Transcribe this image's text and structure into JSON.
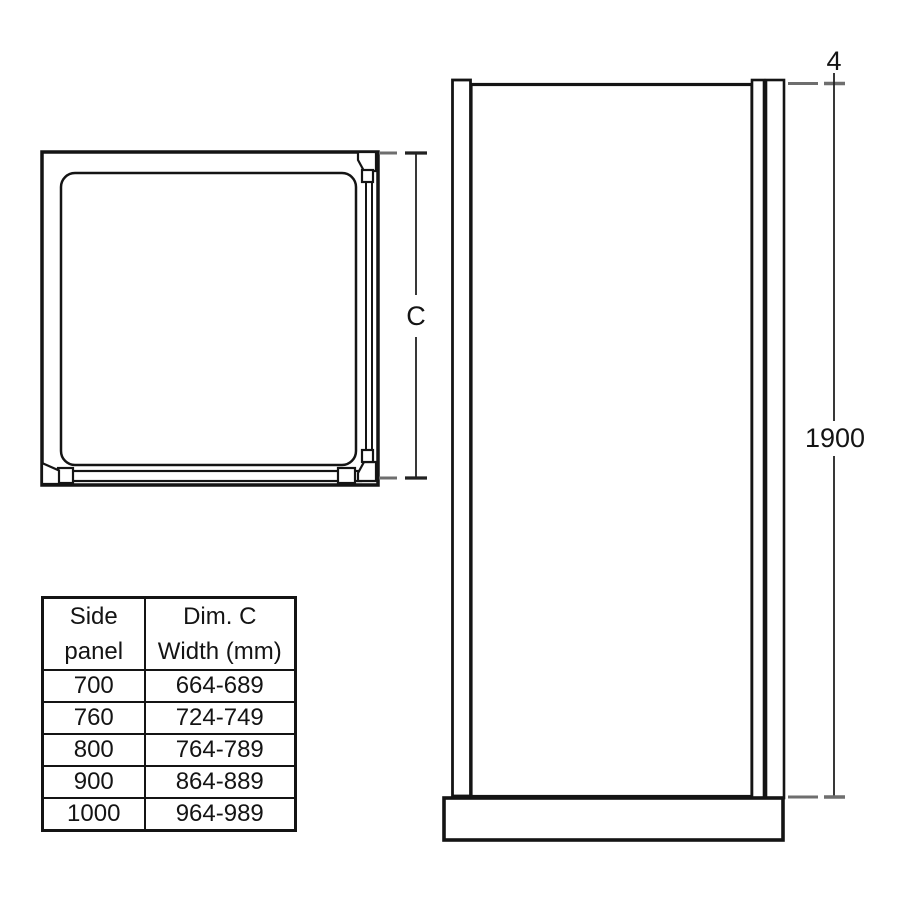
{
  "diagram": {
    "dim_c_label": "C",
    "dim_top_label": "4",
    "dim_height_label": "1900"
  },
  "table": {
    "headers": [
      "Side\npanel",
      "Dim. C\nWidth (mm)"
    ],
    "rows": [
      {
        "panel": "700",
        "width": "664-689"
      },
      {
        "panel": "760",
        "width": "724-749"
      },
      {
        "panel": "800",
        "width": "764-789"
      },
      {
        "panel": "900",
        "width": "864-889"
      },
      {
        "panel": "1000",
        "width": "964-989"
      }
    ]
  },
  "colors": {
    "line": "#141414",
    "extension_dash": "#6e6e6e",
    "background": "#ffffff"
  }
}
